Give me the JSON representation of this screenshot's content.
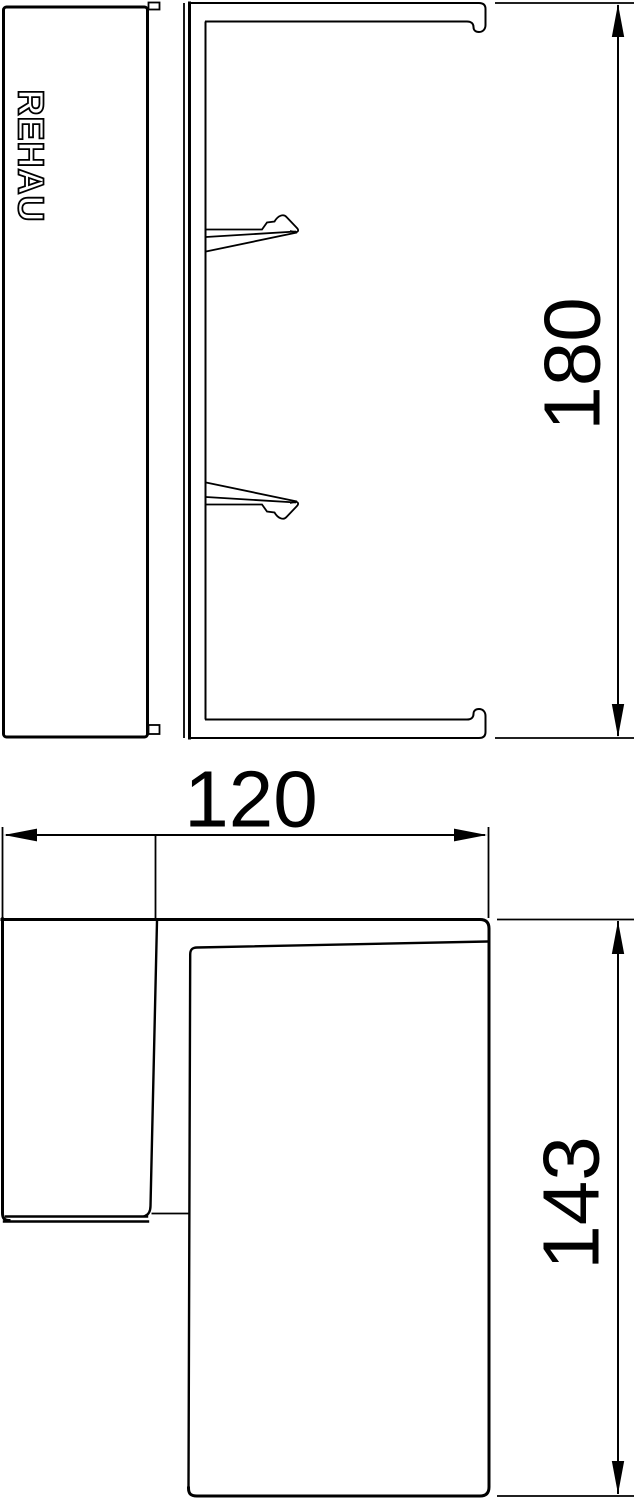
{
  "brand": {
    "label": "REHAU"
  },
  "dimensions": {
    "side_height": {
      "value": "180"
    },
    "front_width": {
      "value": "120"
    },
    "front_height": {
      "value": "143"
    }
  },
  "colors": {
    "line": "#000000",
    "background": "#ffffff"
  }
}
